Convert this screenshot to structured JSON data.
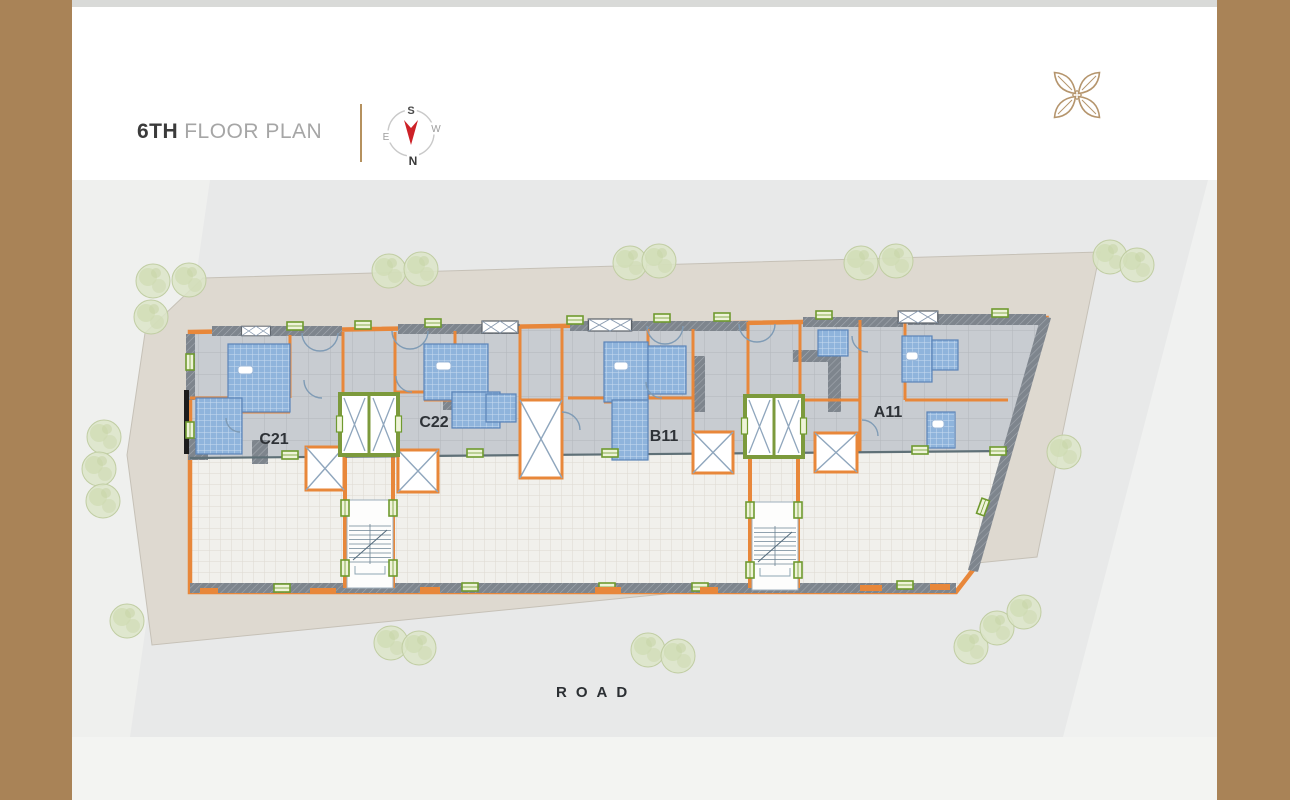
{
  "header": {
    "floor_bold": "6TH",
    "floor_rest": "FLOOR PLAN"
  },
  "compass": {
    "top": "S",
    "right": "W",
    "bottom": "N",
    "left": "E"
  },
  "plan": {
    "units": [
      {
        "label": "C21"
      },
      {
        "label": "C22"
      },
      {
        "label": "B11"
      },
      {
        "label": "A11"
      }
    ],
    "road_label": "ROAD"
  },
  "colors": {
    "accent_brown": "#a98357",
    "wall_orange": "#e8873a",
    "lift_green": "#7c9a3c",
    "bath_blue": "#8fb4dc",
    "site_beige": "#ded9d0",
    "background_gray": "#e8e9e9"
  }
}
